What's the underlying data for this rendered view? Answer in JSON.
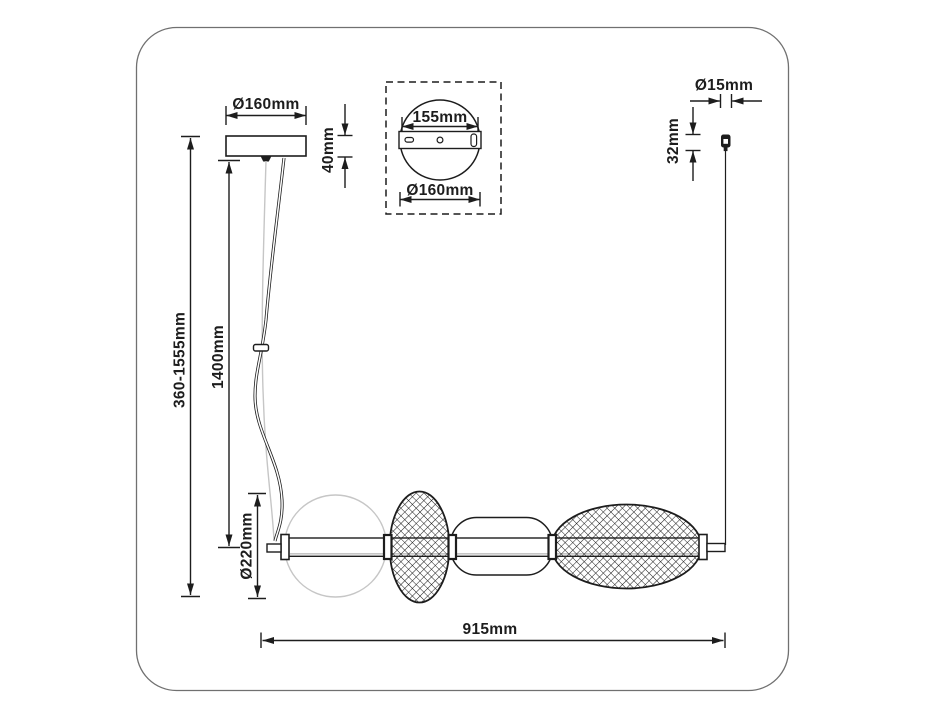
{
  "dimensions": {
    "canopy_diameter": "Ø160mm",
    "canopy_height": "40mm",
    "bracket_length": "155mm",
    "canopy_top_diameter": "Ø160mm",
    "grip_diameter": "Ø15mm",
    "grip_height": "32mm",
    "suspension_range": "360-1555mm",
    "cord_length": "1400mm",
    "sphere_diameter": "Ø220mm",
    "fixture_length": "915mm"
  },
  "colors": {
    "line": "#1d1d1d",
    "frame_border": "#707070",
    "light_gray": "#c6c6c6",
    "background": "#ffffff"
  }
}
